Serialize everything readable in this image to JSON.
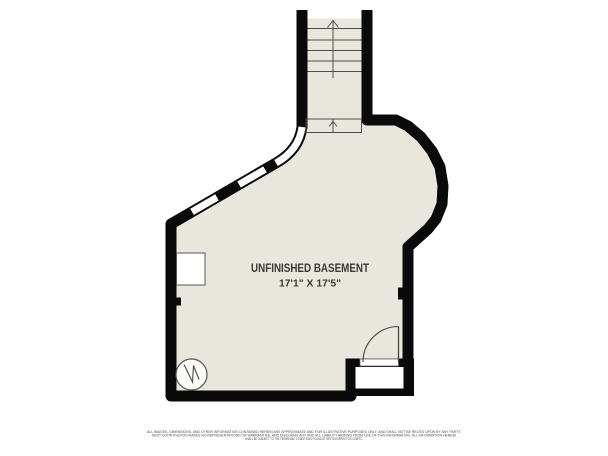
{
  "floorplan": {
    "room": {
      "label": "UNFINISHED BASEMENT",
      "dimensions": "17'1\" X 17'5\""
    },
    "colors": {
      "floor": "#e9e7dd",
      "wall": "#0a0a0a",
      "detail_line": "#4d4d4d",
      "label_text": "#3a3a35",
      "background": "#ffffff"
    },
    "symbols": {
      "stairs": "staircase-up-arrow",
      "water_heater": "water-heater-circle",
      "door": "door-with-swing-arc",
      "windows": "wall-windows",
      "stoop": "exterior-stoop"
    }
  },
  "disclaimer": {
    "line1": "ALL IMAGES, DIMENSIONS, AND OTHER INFORMATION CONTAINED HEREIN ARE APPROXIMATE AND FOR ILLUSTRATIVE PURPOSES ONLY, AND SHALL NOT BE RELIED UPON BY ANY PARTY.",
    "line2": "NEXT DOOR PHOTOS MAKES NO REPRESENTATIONS OR WARRANTIES, AND DISCLAIMS ANY AND ALL LIABILITY ARISING FROM USE OF THIS INFORMATION. ALL INFORMATION HEREIN",
    "line3": "SHALL BE SUBJECT TO THE TERMS AND CONDITIONS FOUND AT NEXTDOORPHOTOS.COM/TC."
  }
}
